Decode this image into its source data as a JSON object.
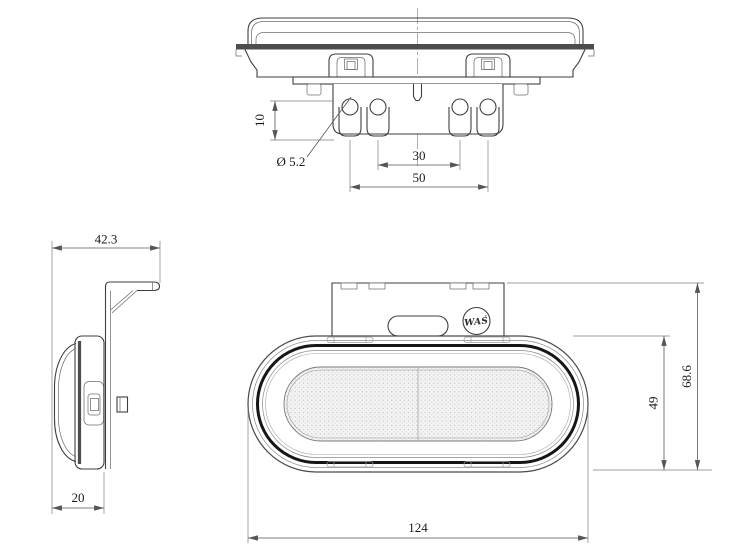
{
  "drawing_type": "technical-drawing-marker-lamp",
  "colors": {
    "background": "#ffffff",
    "outline": "#3f3f3f",
    "thin_line": "#9a9a9a",
    "seam_fill": "#4d4d4d",
    "thick_ring": "#161616",
    "dimension_line": "#555555",
    "dimension_text": "#1b1b1b"
  },
  "views": {
    "top_view": {
      "dims": {
        "pin_length": "10",
        "pin_diameter": "Ø 5.2",
        "pin_spacing_inner": "30",
        "pin_spacing_outer": "50"
      }
    },
    "side_view": {
      "dims": {
        "overall_depth": "42.3",
        "mounting_depth": "20"
      }
    },
    "front_view": {
      "logo_text": "WAŚ",
      "dims": {
        "overall_width": "124",
        "lens_height": "49",
        "overall_height": "68.6"
      }
    }
  }
}
